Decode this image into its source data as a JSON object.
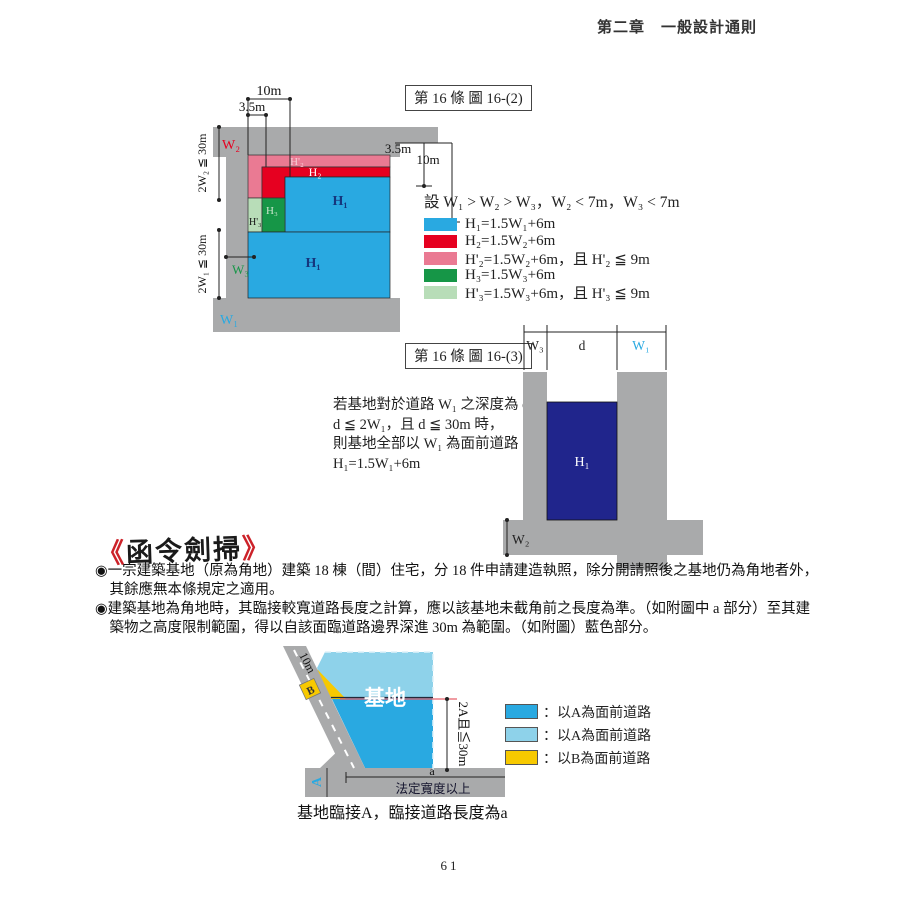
{
  "page": {
    "header": "第二章　一般設計通則",
    "page_number": "61"
  },
  "figure_16_2": {
    "label": "第 16 條 圖 16-(2)",
    "dims": {
      "top_10m": "10m",
      "top_3_5m": "3.5m",
      "right_3_5m": "3.5m",
      "right_10m": "10m",
      "w2_limit": "2W₂ ≦ 30m",
      "w1_limit": "2W₁ ≦ 30m"
    },
    "roads": {
      "w1": "W₁",
      "w2": "W₂",
      "w3": "W₃"
    },
    "zones": {
      "h1_upper": "H₁",
      "h1_lower": "H₁",
      "h2": "H₂",
      "h2p": "H'₂",
      "h3": "H₃",
      "h3p": "H'₃"
    },
    "legend": {
      "assumption": "設 W₁ > W₂ > W₃，W₂ < 7m，W₃ < 7m",
      "items": [
        {
          "color": "#29a9e1",
          "text": "H₁=1.5W₁+6m"
        },
        {
          "color": "#e60020",
          "text": "H₂=1.5W₂+6m"
        },
        {
          "color": "#ea7a93",
          "text": "H'₂=1.5W₂+6m，且 H'₂ ≦ 9m"
        },
        {
          "color": "#169647",
          "text": "H₃=1.5W₃+6m"
        },
        {
          "color": "#b8ddb8",
          "text": "H'₃=1.5W₃+6m，且 H'₃ ≦ 9m"
        }
      ]
    }
  },
  "figure_16_3": {
    "label": "第 16 條 圖 16-(3)",
    "description_lines": [
      "若基地對於道路 W₁ 之深度為 d，",
      "d ≦ 2W₁，且 d ≦ 30m 時，",
      "則基地全部以 W₁ 為面前道路",
      "H₁=1.5W₁+6m"
    ],
    "dims": {
      "w3": "W₃",
      "d": "d",
      "w1": "W₁"
    },
    "zone_h1": "H₁",
    "road_w2": "W₂"
  },
  "directives": {
    "bracket_open": "《",
    "title": "函令劍掃",
    "bracket_close": "》",
    "bullet_marker": "◉",
    "bullets": [
      "一宗建築基地（原為角地）建築 18 棟（間）住宅，分 18 件申請建造執照，除分開請照後之基地仍為角地者外，其餘應無本條規定之適用。",
      "建築基地為角地時，其臨接較寬道路長度之計算，應以該基地未截角前之長度為準。（如附圖中 a 部分）至其建築物之高度限制範圍，得以自該面臨道路邊界深進 30m 為範圍。（如附圖）藍色部分。"
    ]
  },
  "site_figure": {
    "road_b_length": "10m",
    "road_b_label": "B",
    "site_label": "基地",
    "depth_limit": "2A且≦30m",
    "road_a_label": "A",
    "dim_a": "a",
    "legal_width": "法定寬度以上",
    "caption": "基地臨接A，臨接道路長度為a",
    "legend": [
      {
        "color": "#29a9e1",
        "text": "：以A為面前道路"
      },
      {
        "color": "#8ed2ea",
        "text": "：以A為面前道路"
      },
      {
        "color": "#f7c900",
        "text": "：以B為面前道路"
      }
    ]
  },
  "colors": {
    "road_gray": "#a9aaab",
    "h1_blue": "#29a9e1",
    "h2_red": "#e60020",
    "h2p_pink": "#ea7a93",
    "h3_green": "#169647",
    "h3p_lightgreen": "#b8ddb8",
    "navy": "#20258c",
    "site_lightblue": "#8ed2ea",
    "site_yellow": "#f7c900",
    "accent_red_line": "#e8606a"
  }
}
